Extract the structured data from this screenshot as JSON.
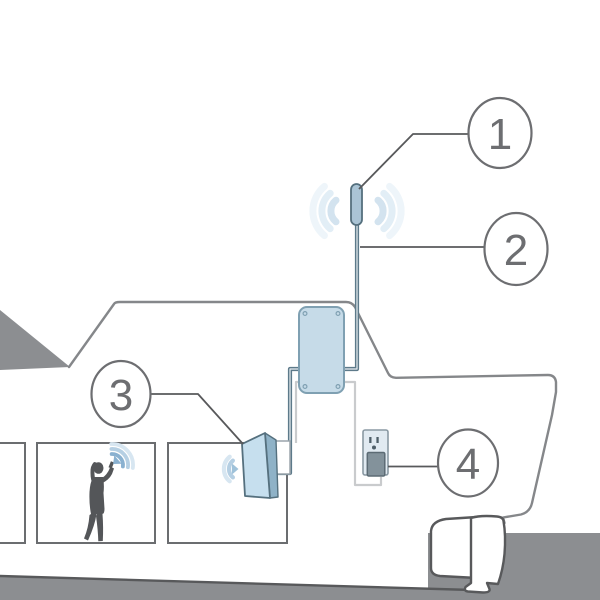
{
  "callouts": [
    {
      "label": "1"
    },
    {
      "label": "2"
    },
    {
      "label": "3"
    },
    {
      "label": "4"
    }
  ],
  "colors": {
    "outline_gray": "#85878a",
    "fill_gray": "#8c8e91",
    "dark_line": "#58595b",
    "room_stroke": "#6b6d70",
    "circle_stroke": "#6d6e71",
    "number_color": "#6d6e71",
    "coax_dark": "#5d7a8a",
    "coax_core": "#e8eef2",
    "cord_light": "#c9cbcd",
    "device_fill": "#c6dbe8",
    "device_stroke": "#7fa0b2",
    "antenna_fill": "#aac4d5",
    "antenna_stroke": "#55707e",
    "panel_front": "#c6dfee",
    "panel_side": "#8fb2c7",
    "bracket_stroke": "#9aa4ab",
    "outlet_fill": "#e1eaf1",
    "outlet_stroke": "#8a99a3",
    "plug_fill": "#83929b",
    "plug_stroke": "#5c6b74",
    "socket_dark": "#4e5e68",
    "person_fill": "#545659",
    "wave_strong": "#8ab1d0",
    "wave_mid": "#b5cfe3",
    "wave_soft": "#d7e6f1",
    "wave_faint0": "#d3e3ef",
    "wave_faint1": "#e2eef6",
    "wave_faint2": "#eef5fa"
  }
}
